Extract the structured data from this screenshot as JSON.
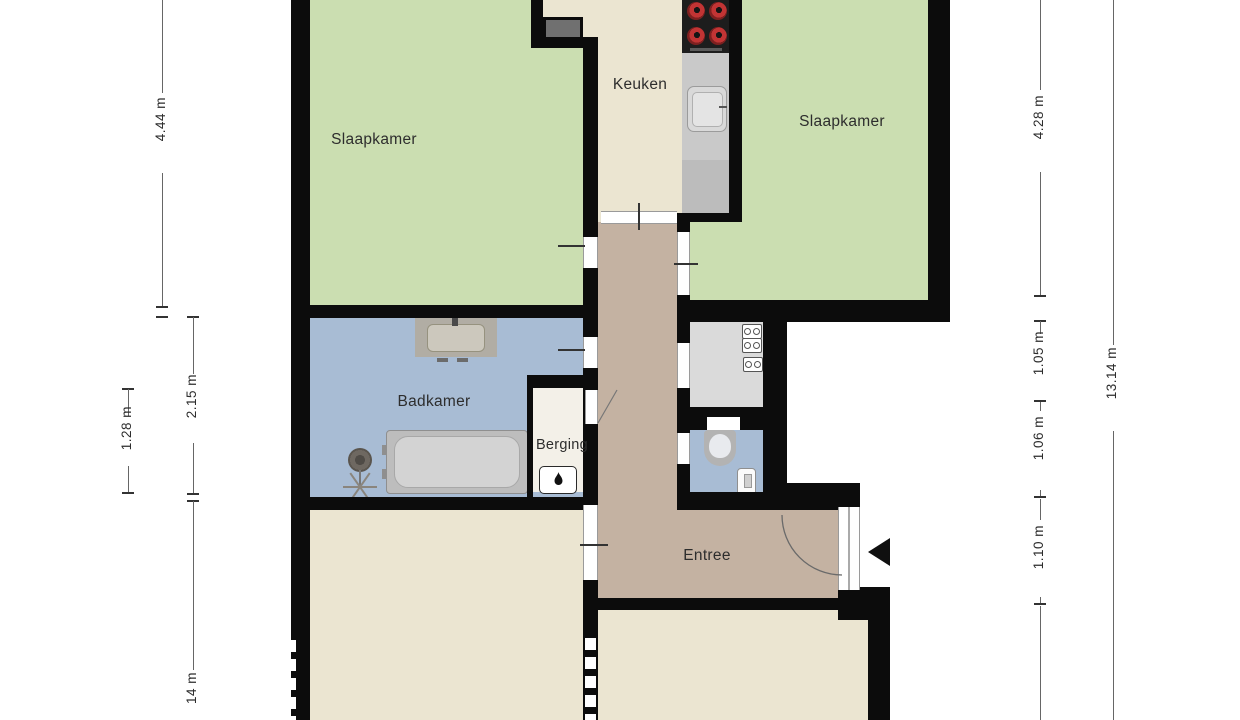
{
  "meta": {
    "type": "floor-plan",
    "language": "Dutch",
    "page_title": "Floor plan"
  },
  "rooms": {
    "bedroom_left": {
      "label": "Slaapkamer"
    },
    "kitchen": {
      "label": "Keuken"
    },
    "bedroom_right": {
      "label": "Slaapkamer"
    },
    "bathroom": {
      "label": "Badkamer"
    },
    "storage": {
      "label": "Berging"
    },
    "entrance": {
      "label": "Entree"
    }
  },
  "dims": {
    "left_inner_top": "4.44 m",
    "left_inner_mid": "2.15 m",
    "left_outer": "1.28 m",
    "left_inner_bottom_partial": "14 m",
    "right_inner_1": "4.28 m",
    "right_inner_2": "1.05 m",
    "right_inner_3": "1.06 m",
    "right_inner_4": "1.10 m",
    "right_outer": "13.14 m"
  },
  "icons": {
    "stove": "stove-burners-icon",
    "kitchen_sink": "kitchen-sink-icon",
    "washbasin": "washbasin-icon",
    "bathtub": "bathtub-icon",
    "shower": "shower-icon",
    "toilet": "toilet-icon",
    "toilet_fountain": "toilet-fountain-icon",
    "boiler_flame": "boiler-flame-icon",
    "meters": "utility-meter-icon",
    "entrance_arrow": "entrance-arrow-icon",
    "door_arc": "door-swing-arc"
  },
  "colors": {
    "wall": "#0c0c0c",
    "green": "#cbdeb1",
    "cream": "#ebe5d1",
    "tan": "#c4b2a2",
    "blue": "#a8bcd4",
    "gray": "#dadada",
    "storage": "#f3f0e8",
    "counter": "#c9c9c9",
    "counterdark": "#bcbcbc",
    "stove": "#1d1d1d",
    "burner": "#c13434",
    "shaft": "#707070",
    "dimline": "#666666",
    "dimtick": "#333333",
    "labelcol": "#2d2d2d"
  }
}
